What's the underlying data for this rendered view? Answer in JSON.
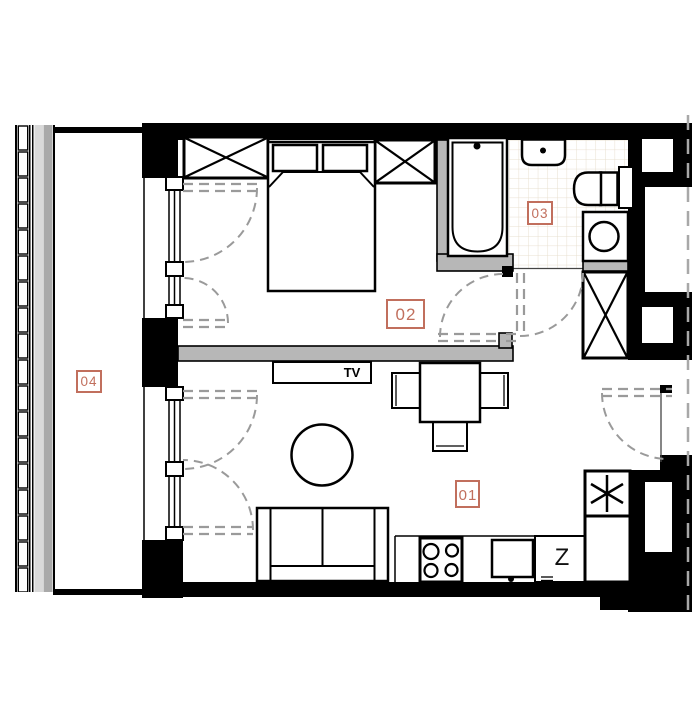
{
  "plan": {
    "rooms": [
      {
        "id": "room-01",
        "label": "01"
      },
      {
        "id": "room-02",
        "label": "02"
      },
      {
        "id": "room-03",
        "label": "03"
      },
      {
        "id": "room-04",
        "label": "04"
      }
    ],
    "labels": {
      "tv": "TV",
      "dishwasher": "Z"
    },
    "icons": {
      "fridge": "snowflake-icon",
      "wardrobe": "x-cross-icon",
      "washing_machine": "drum-circle-icon"
    },
    "colors": {
      "wall": "#000000",
      "partition_fill": "#b7b7b7",
      "door_swing": "#9a9a9a",
      "room_label": "#c16f5d",
      "tile_line": "#e7dfcf",
      "railing_gray": "#a9a9a9"
    }
  }
}
